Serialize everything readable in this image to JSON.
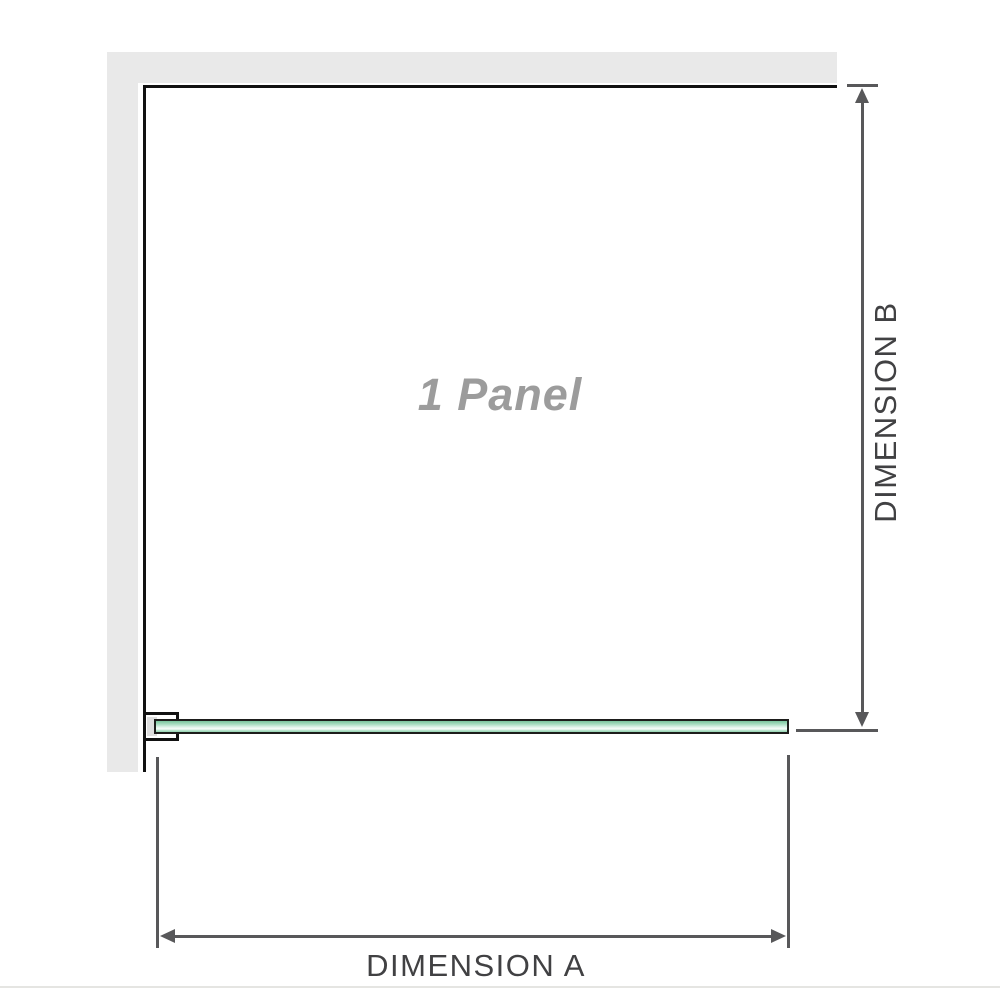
{
  "diagram": {
    "panel_label": "1 Panel",
    "dimension_a_label": "DIMENSION A",
    "dimension_b_label": "DIMENSION B"
  },
  "colors": {
    "wall": "#e9e9e9",
    "edge": "#111111",
    "dim": "#58585a",
    "dim-text": "#414143",
    "watermark": "#9c9c9c",
    "glass-border": "#1d1d1b",
    "glass-top": "#79c59d",
    "glass-upper": "#a6dcbf",
    "glass-mid": "#dff3e9",
    "glass-highlight": "#f8fdfa",
    "glass-lower": "#bfe7d1",
    "glass-bottom": "#93d2b0",
    "bracket-pad": "#dedede",
    "baseline": "#e5e5e2"
  }
}
